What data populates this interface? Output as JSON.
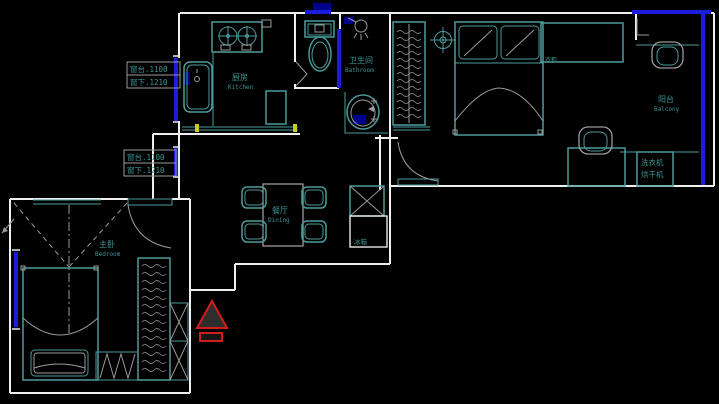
{
  "canvas": {
    "width": 719,
    "height": 404,
    "background": "#000000"
  },
  "colors": {
    "wall": "#efefef",
    "fixture_teal": "#4d9a9a",
    "fixture_gray": "#9a9a9a",
    "window_blue": "#1c1cdc",
    "window_navy": "#00008b",
    "label_teal": "#3d9494",
    "entry_red": "#d31c1c",
    "tick_yellow": "#c8c832"
  },
  "rooms": {
    "kitchen": {
      "name_zh": "厨房",
      "name_en": "Kitchen"
    },
    "bathroom": {
      "name_zh": "卫生间",
      "name_en": "Bathroom"
    },
    "dining": {
      "name_zh": "餐厅",
      "name_en": "Dining"
    },
    "bedroom": {
      "name_zh": "主卧",
      "name_en": "Bedroom"
    },
    "balcony": {
      "name_zh": "阳台",
      "name_en": "Balcony"
    }
  },
  "annotations": {
    "window_top": {
      "line1": "窗台.1100",
      "line2": "窗下.1210"
    },
    "window_bottom": {
      "line1": "窗台.1100",
      "line2": "窗下.1210"
    },
    "washer_dryer": {
      "line1": "洗衣机",
      "line2": "烘干机"
    },
    "fridge": {
      "label": "冰箱"
    },
    "cabinet": {
      "label": "衣柜"
    }
  }
}
